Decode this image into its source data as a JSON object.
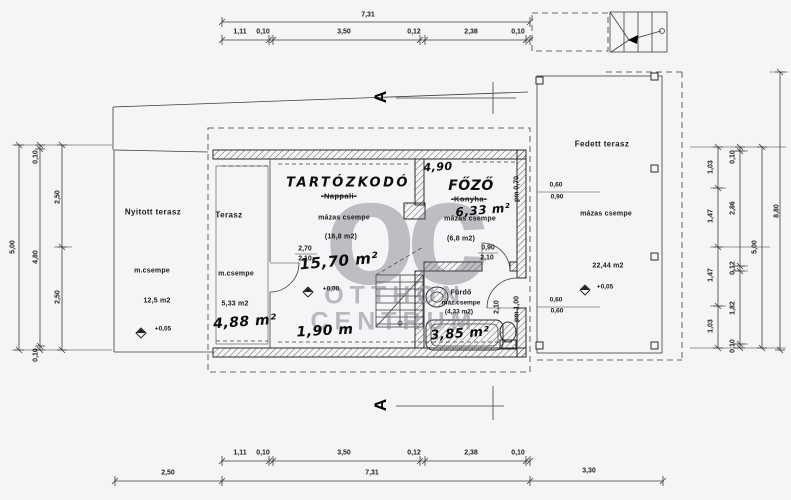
{
  "colors": {
    "paper": "#f4f5f7",
    "ink": "#1b1b1b",
    "watermark_gray": "#9a9aa0"
  },
  "watermark": {
    "logo": "oc",
    "line1": "OTTHON",
    "line2": "CENTRUM"
  },
  "section": {
    "label": "A"
  },
  "dims": {
    "top": {
      "total": "7,31",
      "segments": [
        "1,11",
        "0,10",
        "3,50",
        "0,12",
        "2,38",
        "0,10"
      ]
    },
    "bottom": {
      "segments": [
        "1,11",
        "0,10",
        "3,50",
        "0,12",
        "2,38",
        "0,10"
      ],
      "totals": [
        "2,50",
        "7,31",
        "3,30"
      ]
    },
    "left": {
      "overall": "5,00",
      "chain": [
        "0,10",
        "4,80",
        "0,10"
      ],
      "halves": [
        "2,50",
        "2,50"
      ]
    },
    "right": {
      "bays": [
        "1,03",
        "1,47",
        "1,47",
        "1,03"
      ],
      "chain": [
        "0,10",
        "2,86",
        "0,12",
        "1,82",
        "0,10"
      ],
      "overall": "5,00",
      "total": "8,80"
    }
  },
  "rooms": {
    "nyitott_terasz": {
      "name": "Nyitott terasz",
      "surface": "m.csempe",
      "area": "12,5 m2",
      "level": "+0,05"
    },
    "terasz": {
      "name": "Terasz",
      "surface": "m.csempe",
      "area": "5,33 m2",
      "note": "4,88 m²"
    },
    "tartozkodo": {
      "name": "TARTÓZKODÓ",
      "old_name": "-Nappali-",
      "surface": "mázas csempe",
      "area": "(16,8 m2)",
      "note": "15,70 m²",
      "level": "+0,00",
      "opening": [
        "2,70",
        "2,10"
      ]
    },
    "fozo": {
      "name": "FŐZŐ",
      "old_name": "-Konyha-",
      "surface": "mázas csempe",
      "area": "(6,8 m2)",
      "note": "6,33 m²",
      "width_note": "4,90",
      "opening": [
        "0,90",
        "2,10"
      ],
      "parapet": "pm 0,70"
    },
    "furdo": {
      "name": "Fürdő",
      "surface": "máz.csempe",
      "area": "(4,33 m2)",
      "note": "3,85 m²",
      "opening": "2,10",
      "parapet": "pm 1,00"
    },
    "fedett_terasz": {
      "name": "Fedett terasz",
      "surface": "mázas csempe",
      "area": "22,44 m2",
      "level": "+0,05",
      "openings": [
        [
          "0,60",
          "0,90"
        ],
        [
          "0,60",
          "0,60"
        ]
      ]
    },
    "bottom_note": "1,90 m"
  }
}
